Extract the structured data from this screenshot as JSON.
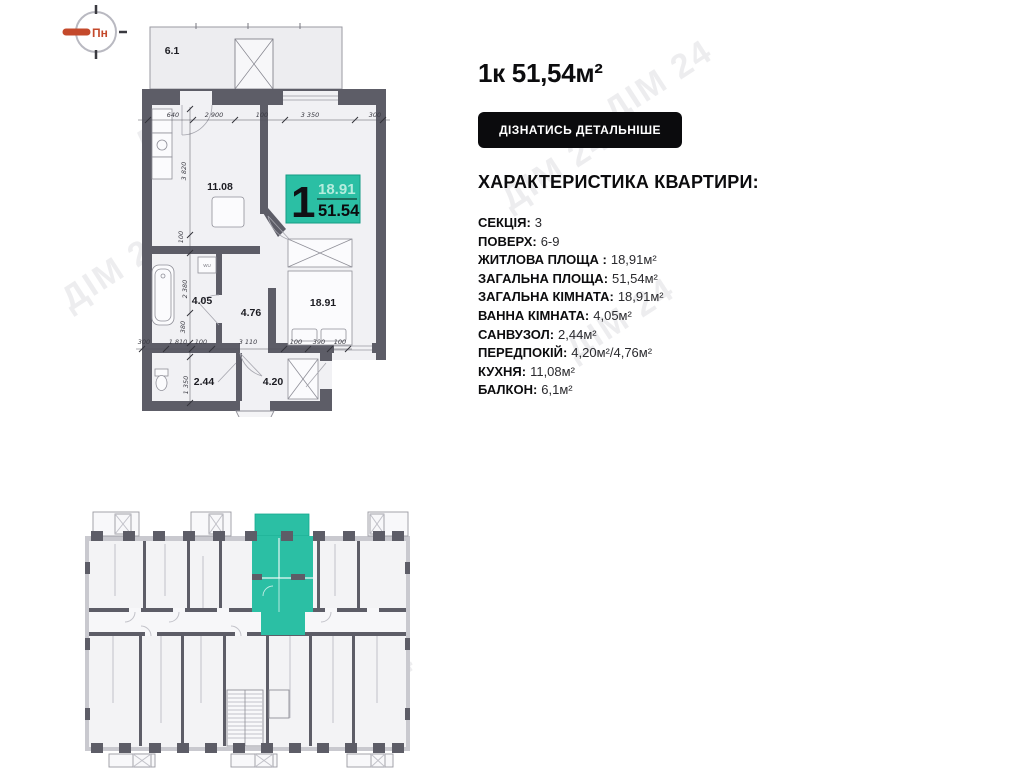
{
  "compass": {
    "label": "Пн"
  },
  "listing": {
    "title": "1к 51,54м²",
    "details_button": "ДІЗНАТИСЬ ДЕТАЛЬНІШЕ",
    "characteristics_heading": "ХАРАКТЕРИСТИКА КВАРТИРИ:",
    "characteristics": [
      {
        "label": "СЕКЦІЯ:",
        "value": "3"
      },
      {
        "label": "ПОВЕРХ:",
        "value": "6-9"
      },
      {
        "label": "ЖИТЛОВА ПЛОЩА :",
        "value": "18,91м²"
      },
      {
        "label": "ЗАГАЛЬНА ПЛОЩА:",
        "value": "51,54м²"
      },
      {
        "label": "ЗАГАЛЬНА КІМНАТА:",
        "value": "18,91м²"
      },
      {
        "label": "ВАННА КІМНАТА:",
        "value": "4,05м²"
      },
      {
        "label": "САНВУЗОЛ:",
        "value": "2,44м²"
      },
      {
        "label": "ПЕРЕДПОКІЙ:",
        "value": "4,20м²/4,76м²"
      },
      {
        "label": "КУХНЯ:",
        "value": "11,08м²"
      },
      {
        "label": "БАЛКОН:",
        "value": "6,1м²"
      }
    ]
  },
  "floorplan": {
    "badge": {
      "rooms_count": "1",
      "living_area": "18.91",
      "total_area": "51.54"
    },
    "room_labels": {
      "balcony": "6.1",
      "kitchen": "11.08",
      "living": "18.91",
      "bathroom": "4.05",
      "hall": "4.76",
      "wc": "2.44",
      "entry": "4.20"
    },
    "washer_label": "WU",
    "dims_top": [
      "640",
      "2 900",
      "100",
      "3 350",
      "300"
    ],
    "dims_left": [
      "3 820",
      "100",
      "2 380",
      "380",
      "1 350"
    ],
    "dims_bottom": [
      "300",
      "1 810",
      "100",
      "3 110",
      "100",
      "390",
      "100"
    ]
  },
  "watermark": {
    "text": "ДІМ 24"
  },
  "colors": {
    "accent_teal": "#2bbfa4",
    "wall_gray": "#5d5d67",
    "button_black": "#0b0b0d",
    "compass_red": "#c4492b"
  }
}
